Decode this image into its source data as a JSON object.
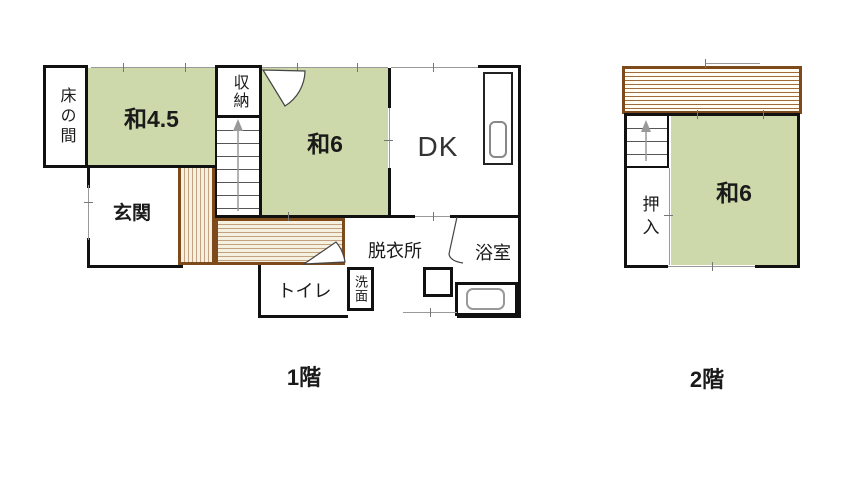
{
  "title_labels": {
    "floor1": "1階",
    "floor2": "2階"
  },
  "floor1": {
    "tokonoma": "床の間",
    "tatami45": "和4.5",
    "storage": "収納",
    "tatami6": "和6",
    "dining_kitchen": "DK",
    "entrance": "玄関",
    "toilet": "トイレ",
    "washbasin": "洗面",
    "dressing_room": "脱衣所",
    "bathroom": "浴室"
  },
  "floor2": {
    "closet": "押入",
    "tatami6": "和6"
  },
  "colors": {
    "tatami_green": "#cdd9aa",
    "wood_border": "#7d4a1c",
    "wood_stripe": "#c2a280",
    "wall_black": "#111111"
  }
}
